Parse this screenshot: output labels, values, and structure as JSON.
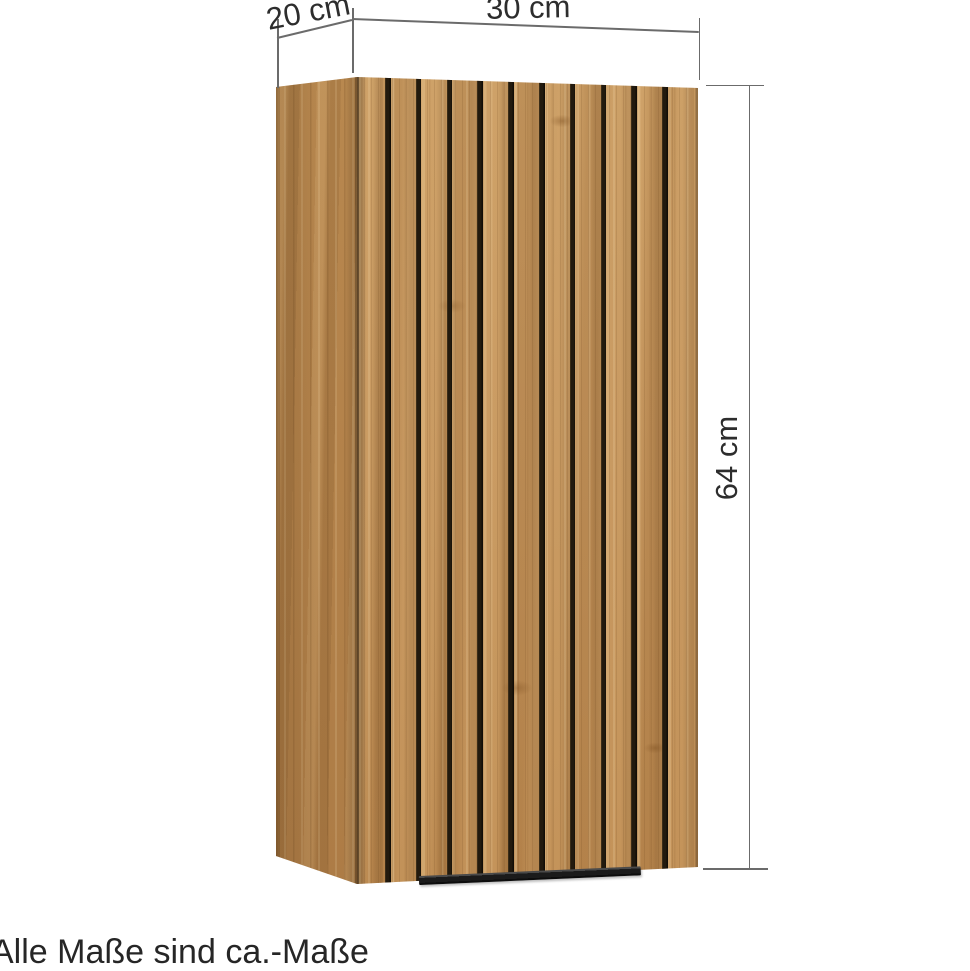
{
  "product_diagram": {
    "dimension_labels": {
      "depth": "20 cm",
      "width": "30 cm",
      "height": "64 cm"
    },
    "footnote": "Alle Maße sind ca.-Maße",
    "cabinet": {
      "description": "wall cabinet with vertical slat front and black grooves",
      "slat_groove_count": 10,
      "groove_pitch_px": 30.8,
      "groove_first_offset_px": 28
    },
    "colors": {
      "background": "#ffffff",
      "wood_front": "#c4935a",
      "wood_side": "#b2824c",
      "slat_groove": "#1f1810",
      "handle": "#1b1b1b",
      "dimension_line": "#6b6b6b",
      "text": "#2d2d2d"
    }
  }
}
